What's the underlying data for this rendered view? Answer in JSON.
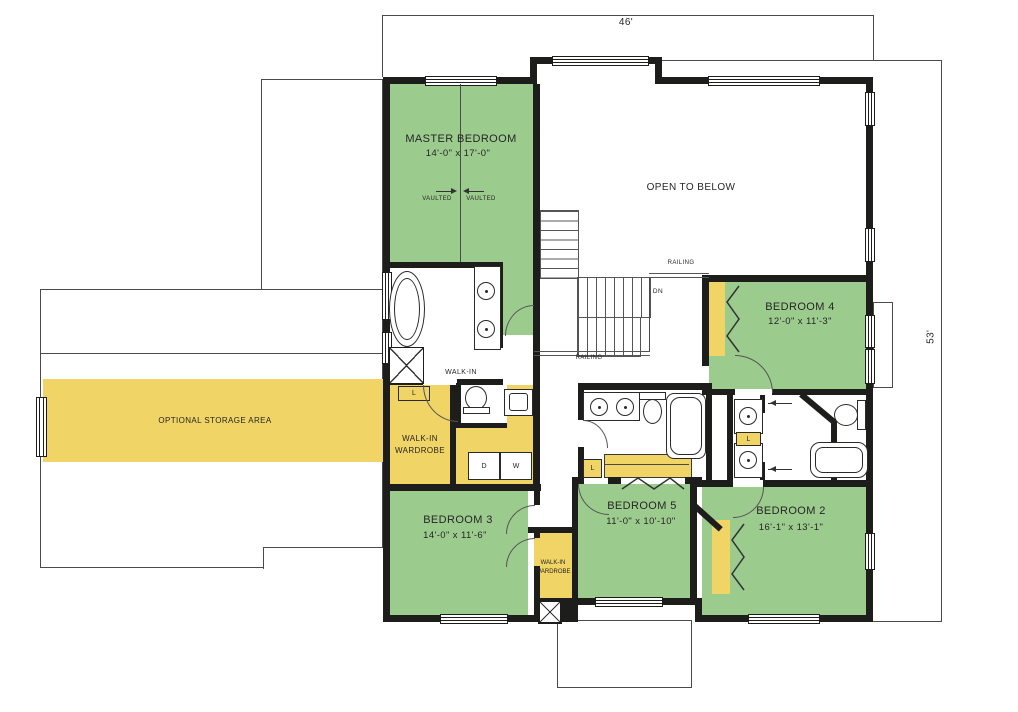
{
  "dims": {
    "width_label": "46'",
    "height_label": "53'"
  },
  "rooms": {
    "master_bedroom": {
      "name": "MASTER BEDROOM",
      "dims": "14'-0\" x 17'-0\""
    },
    "bedroom_2": {
      "name": "BEDROOM 2",
      "dims": "16'-1\" x 13'-1\""
    },
    "bedroom_3": {
      "name": "BEDROOM 3",
      "dims": "14'-0\" x 11'-6\""
    },
    "bedroom_4": {
      "name": "BEDROOM 4",
      "dims": "12'-0\" x 11'-3\""
    },
    "bedroom_5": {
      "name": "BEDROOM 5",
      "dims": "11'-0\" x 10'-10\""
    }
  },
  "areas": {
    "open_to_below": "OPEN TO BELOW",
    "optional_storage": "OPTIONAL STORAGE AREA",
    "walk_in": "WALK-IN",
    "wardrobe_line1": "WALK-IN",
    "wardrobe_line2": "WARDROBE"
  },
  "annotations": {
    "railing": "RAILING",
    "down": "DN",
    "vaulted": "VAULTED"
  },
  "tags": {
    "linen": "L",
    "dryer": "D",
    "washer": "W"
  },
  "colors": {
    "room_green": "#9ccb8e",
    "closet_yellow": "#f0d465",
    "wall": "#1d1d1b"
  }
}
